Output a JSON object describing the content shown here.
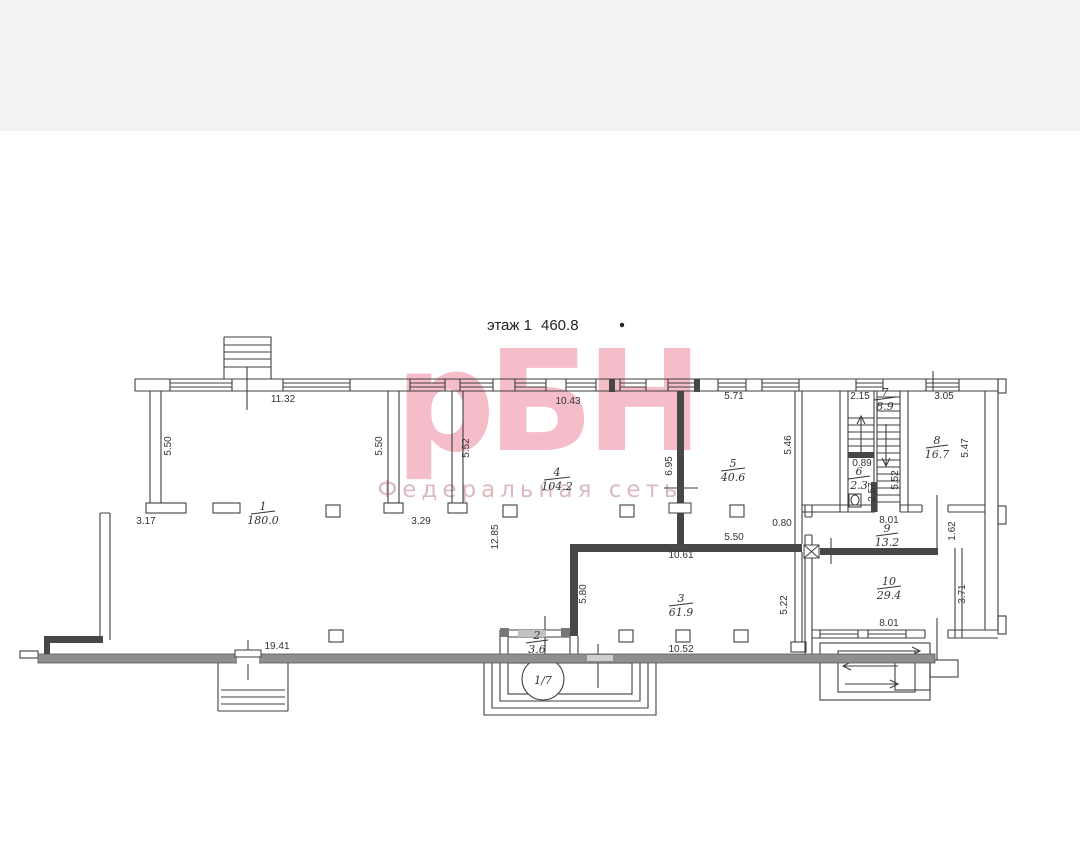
{
  "page": {
    "background_color": "#ffffff",
    "top_band_color": "#f1f2f4",
    "title": {
      "floor": "этаж 1",
      "area": "460.8"
    }
  },
  "watermark": {
    "logo_text": "рБН",
    "subtitle": "Федеральная сеть",
    "logo_color": "#f5bdc9",
    "subtitle_color": "#dcb9bf"
  },
  "plan": {
    "line_color": "#3f3f3f",
    "entrance_axis_label": "1/7",
    "rooms": [
      {
        "id": "1",
        "area": "180.0"
      },
      {
        "id": "2",
        "area": "3.6"
      },
      {
        "id": "3",
        "area": "61.9"
      },
      {
        "id": "4",
        "area": "104.2"
      },
      {
        "id": "5",
        "area": "40.6"
      },
      {
        "id": "6",
        "area": "2.3"
      },
      {
        "id": "7",
        "area": "8.9"
      },
      {
        "id": "8",
        "area": "16.7"
      },
      {
        "id": "9",
        "area": "13.2"
      },
      {
        "id": "10",
        "area": "29.4"
      }
    ],
    "dims": {
      "r1_top": "11.32",
      "r1_left": "5.50",
      "r1_right": "5.50",
      "r4_left": "5.52",
      "r4_top": "10.43",
      "r5_top": "5.71",
      "r5_right": "5.46",
      "divider_45": "6.95",
      "stair_top": "2.15",
      "r8_top": "3.05",
      "r8_right": "5.47",
      "wc_w": "0.89",
      "wc_h": "2.57",
      "stair_right": "5.52",
      "left_offset": "3.17",
      "r1_bottom": "3.29",
      "mid_height": "12.85",
      "door_r9": "0.80",
      "r9_top": "8.01",
      "r9_right": "1.62",
      "r5_bottom": "5.50",
      "r3_top": "10.61",
      "r3_left": "5.80",
      "r3_right": "5.22",
      "r10_right": "3.71",
      "r10_bottom": "8.01",
      "r3_bottom": "10.52",
      "bottom_left": "19.41"
    }
  }
}
